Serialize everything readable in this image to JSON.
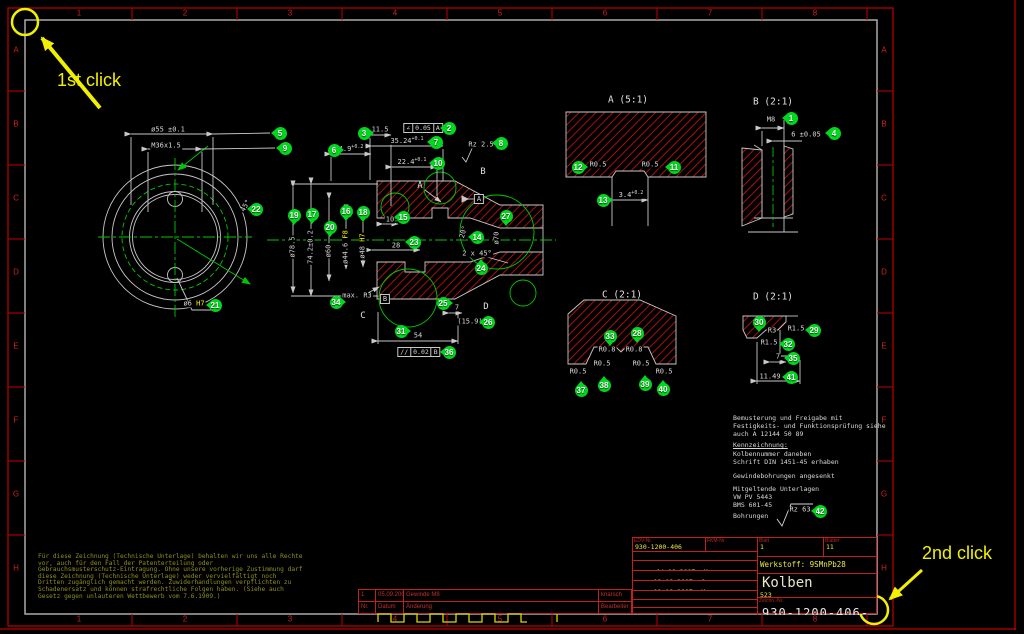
{
  "annotations": {
    "first_click": "1st click",
    "second_click": "2nd click"
  },
  "ruler": {
    "cols": [
      "1",
      "2",
      "3",
      "4",
      "5",
      "6",
      "7",
      "8"
    ],
    "rows": [
      "A",
      "B",
      "C",
      "D",
      "E",
      "F",
      "G",
      "H"
    ]
  },
  "view_titles": [
    {
      "t": "A  (5:1)",
      "x": 628,
      "y": 100
    },
    {
      "t": "B  (2:1)",
      "x": 773,
      "y": 102
    },
    {
      "t": "C  (2:1)",
      "x": 622,
      "y": 295
    },
    {
      "t": "D  (2:1)",
      "x": 773,
      "y": 297
    }
  ],
  "view_letters": [
    {
      "t": "A",
      "x": 420,
      "y": 186
    },
    {
      "t": "B",
      "x": 483,
      "y": 172
    },
    {
      "t": "C",
      "x": 363,
      "y": 316
    },
    {
      "t": "D",
      "x": 486,
      "y": 307
    }
  ],
  "datums": [
    {
      "t": "A",
      "x": 479,
      "y": 199
    },
    {
      "t": "B",
      "x": 385,
      "y": 299
    }
  ],
  "gdt_frames": [
    {
      "sym": "∠",
      "val": "0.05",
      "ref": "A",
      "x": 423,
      "y": 128
    },
    {
      "sym": "//",
      "val": "0.02",
      "ref": "B",
      "x": 419,
      "y": 352
    }
  ],
  "dims": [
    {
      "t": "ø55 ±0.1",
      "x": 168,
      "y": 130
    },
    {
      "t": "M36x1.5",
      "x": 166,
      "y": 146
    },
    {
      "t": "45°",
      "x": 246,
      "y": 206,
      "r": -60
    },
    {
      "t": "ø6 ",
      "x": 194,
      "y": 304,
      "fit": "H7"
    },
    {
      "t": "11.5",
      "x": 380,
      "y": 130
    },
    {
      "t": "4.9",
      "x": 351,
      "y": 149,
      "tol": "+0.2"
    },
    {
      "t": "35.24",
      "x": 407,
      "y": 141,
      "tol": "+0.1"
    },
    {
      "t": "22.4",
      "x": 412,
      "y": 162,
      "tol": "+0.1"
    },
    {
      "t": "Rz 2.5",
      "x": 481,
      "y": 145
    },
    {
      "t": "ø78.5",
      "x": 293,
      "y": 247,
      "r": -90
    },
    {
      "t": "74.2±0.2",
      "x": 311,
      "y": 247,
      "r": -90
    },
    {
      "t": "ø60",
      "x": 329,
      "y": 251,
      "r": -90
    },
    {
      "t": "ø44.6 ",
      "x": 346,
      "y": 247,
      "r": -90,
      "fit": "F8"
    },
    {
      "t": "ø48 ",
      "x": 363,
      "y": 246,
      "r": -90,
      "fit": "H7"
    },
    {
      "t": "10",
      "x": 390,
      "y": 220
    },
    {
      "t": "28",
      "x": 396,
      "y": 246
    },
    {
      "t": "20°",
      "x": 464,
      "y": 232,
      "r": -75
    },
    {
      "t": "ø70",
      "x": 497,
      "y": 238,
      "r": -90
    },
    {
      "t": "2 x 45°",
      "x": 477,
      "y": 254
    },
    {
      "t": "max. R3",
      "x": 357,
      "y": 296
    },
    {
      "t": "7",
      "x": 457,
      "y": 308
    },
    {
      "t": "(15.9)",
      "x": 470,
      "y": 322
    },
    {
      "t": "54",
      "x": 418,
      "y": 336
    },
    {
      "t": "R0.5",
      "x": 598,
      "y": 165
    },
    {
      "t": "R0.5",
      "x": 650,
      "y": 165
    },
    {
      "t": "3.4",
      "x": 631,
      "y": 195,
      "tol": "+0.2"
    },
    {
      "t": "M8",
      "x": 771,
      "y": 120
    },
    {
      "t": "6 ±0.05",
      "x": 806,
      "y": 135
    },
    {
      "t": "R0.8",
      "x": 607,
      "y": 350
    },
    {
      "t": "R0.8",
      "x": 634,
      "y": 350
    },
    {
      "t": "R0.5",
      "x": 578,
      "y": 372
    },
    {
      "t": "R0.5",
      "x": 602,
      "y": 364
    },
    {
      "t": "R0.5",
      "x": 641,
      "y": 364
    },
    {
      "t": "R0.5",
      "x": 664,
      "y": 372
    },
    {
      "t": "R3",
      "x": 772,
      "y": 331
    },
    {
      "t": "R1.5",
      "x": 796,
      "y": 329
    },
    {
      "t": "R1.5",
      "x": 769,
      "y": 343
    },
    {
      "t": "7",
      "x": 778,
      "y": 357
    },
    {
      "t": "11.49",
      "x": 770,
      "y": 377
    },
    {
      "t": "Rz 63",
      "x": 800,
      "y": 510
    }
  ],
  "balloons": [
    {
      "n": "1",
      "x": 791,
      "y": 118,
      "d": "l"
    },
    {
      "n": "2",
      "x": 449,
      "y": 128,
      "d": "l"
    },
    {
      "n": "3",
      "x": 364,
      "y": 133,
      "d": "r"
    },
    {
      "n": "4",
      "x": 834,
      "y": 133,
      "d": "l"
    },
    {
      "n": "5",
      "x": 280,
      "y": 133,
      "d": "l"
    },
    {
      "n": "6",
      "x": 334,
      "y": 150,
      "d": "r"
    },
    {
      "n": "7",
      "x": 436,
      "y": 142,
      "d": "l"
    },
    {
      "n": "8",
      "x": 501,
      "y": 143,
      "d": "l"
    },
    {
      "n": "9",
      "x": 285,
      "y": 148,
      "d": "l"
    },
    {
      "n": "10",
      "x": 438,
      "y": 163,
      "d": "l"
    },
    {
      "n": "11",
      "x": 674,
      "y": 167,
      "d": "l"
    },
    {
      "n": "12",
      "x": 578,
      "y": 167,
      "d": "r"
    },
    {
      "n": "13",
      "x": 603,
      "y": 200,
      "d": "r"
    },
    {
      "n": "14",
      "x": 477,
      "y": 237,
      "d": "l"
    },
    {
      "n": "15",
      "x": 403,
      "y": 217,
      "d": "l"
    },
    {
      "n": "16",
      "x": 346,
      "y": 211,
      "d": "d"
    },
    {
      "n": "17",
      "x": 312,
      "y": 214,
      "d": "d"
    },
    {
      "n": "18",
      "x": 363,
      "y": 212,
      "d": "d"
    },
    {
      "n": "19",
      "x": 294,
      "y": 215,
      "d": "d"
    },
    {
      "n": "20",
      "x": 330,
      "y": 227,
      "d": "d"
    },
    {
      "n": "21",
      "x": 215,
      "y": 305,
      "d": "l"
    },
    {
      "n": "22",
      "x": 256,
      "y": 209,
      "d": "l"
    },
    {
      "n": "23",
      "x": 414,
      "y": 242,
      "d": "l"
    },
    {
      "n": "24",
      "x": 481,
      "y": 268,
      "d": "u"
    },
    {
      "n": "25",
      "x": 443,
      "y": 303,
      "d": "r"
    },
    {
      "n": "26",
      "x": 488,
      "y": 322,
      "d": "l"
    },
    {
      "n": "27",
      "x": 506,
      "y": 216,
      "d": "d"
    },
    {
      "n": "28",
      "x": 637,
      "y": 333,
      "d": "d"
    },
    {
      "n": "29",
      "x": 814,
      "y": 330,
      "d": "l"
    },
    {
      "n": "30",
      "x": 759,
      "y": 322,
      "d": "d"
    },
    {
      "n": "31",
      "x": 401,
      "y": 331,
      "d": "r"
    },
    {
      "n": "32",
      "x": 788,
      "y": 344,
      "d": "l"
    },
    {
      "n": "33",
      "x": 610,
      "y": 336,
      "d": "d"
    },
    {
      "n": "34",
      "x": 336,
      "y": 302,
      "d": "r"
    },
    {
      "n": "35",
      "x": 793,
      "y": 358,
      "d": "l"
    },
    {
      "n": "36",
      "x": 449,
      "y": 352,
      "d": "l"
    },
    {
      "n": "37",
      "x": 581,
      "y": 390,
      "d": "u"
    },
    {
      "n": "38",
      "x": 604,
      "y": 385,
      "d": "u"
    },
    {
      "n": "39",
      "x": 645,
      "y": 384,
      "d": "u"
    },
    {
      "n": "40",
      "x": 663,
      "y": 389,
      "d": "u"
    },
    {
      "n": "41",
      "x": 791,
      "y": 377,
      "d": "l"
    },
    {
      "n": "42",
      "x": 820,
      "y": 511,
      "d": "l"
    }
  ],
  "notes": [
    {
      "t": "Bemusterung und Freigabe mit",
      "y": 414
    },
    {
      "t": "Festigkeits- und Funktionsprüfung siehe",
      "y": 422
    },
    {
      "t": "auch A 12144 50 89",
      "y": 430
    },
    {
      "t": "Kennzeichnung:",
      "y": 441,
      "u": 1
    },
    {
      "t": "Kolbennummer daneben",
      "y": 450
    },
    {
      "t": "Schrift DIN 1451-45 erhaben",
      "y": 458
    },
    {
      "t": "Gewindebohrungen angesenkt",
      "y": 472
    },
    {
      "t": "Mitgeltende Unterlagen",
      "y": 485
    },
    {
      "t": "VW PV 5443",
      "y": 493
    },
    {
      "t": "BMS 601-45",
      "y": 501
    },
    {
      "t": "Bohrungen",
      "y": 512
    }
  ],
  "legal": [
    "Für diese Zeichnung (Technische Unterlage) behalten wir uns alle Rechte",
    "vor, auch für den Fall der Patenterteilung oder",
    "Gebrauchsmusterschutz-Eintragung. Ohne unsere vorherige Zustimmung darf",
    "diese Zeichnung (Technische Unterlage) weder vervielfältigt noch",
    "Dritten zugänglich gemacht werden. Zuwiderhandlungen verpflichten zu",
    "Schadenersatz und können strafrechtliche Folgen haben. (Siehe auch",
    "Gesetz gegen unlauteren Wettbewerb vom 7.6.1909.)"
  ],
  "revision": {
    "cols": [
      "Nr.",
      "Datum",
      "Änderung",
      "Bearbeiter"
    ],
    "row": [
      "1",
      "05.09.2007",
      "Gewinde M8",
      "knarsch"
    ]
  },
  "titleblock": {
    "edv_label": "EDV-Nr.",
    "edv": "930-1200-406",
    "fkm_label": "FKM-Nr.",
    "format_label": "Format",
    "format": "A2",
    "rows": [
      {
        "label": "Bearb.",
        "date": "04.09.2007",
        "by": "Me"
      },
      {
        "label": "Gepr.",
        "date": "12.09.2007",
        "by": "So"
      },
      {
        "label": "Norm",
        "date": "11.09.2007",
        "by": "Ma"
      },
      {
        "label": "Ausg.",
        "date": "18.09.2007",
        "by": "Me"
      }
    ],
    "zust_label": "Zust.",
    "zust": "1.0,",
    "vertr_label": "Vertr.-Nr.",
    "vertr": "89-45/7841",
    "blatt_label": "Blatt",
    "blatt": "1",
    "blaetter_label": "Blätter",
    "blaetter": "11",
    "werkstoff": "Werkstoff: 9SMnPb28",
    "part_name": "Kolben",
    "part_sub": "523",
    "zeichn_label": "Zeichn.-Nr.",
    "zeichn": "930-1200-406-1"
  },
  "colors": {
    "frame_red": "#c00000",
    "geometry": "#c8c8c8",
    "green": "#00c800",
    "balloon_green": "#00d81e",
    "hatch_red": "#bb1111",
    "click_yellow": "#f0f000"
  }
}
